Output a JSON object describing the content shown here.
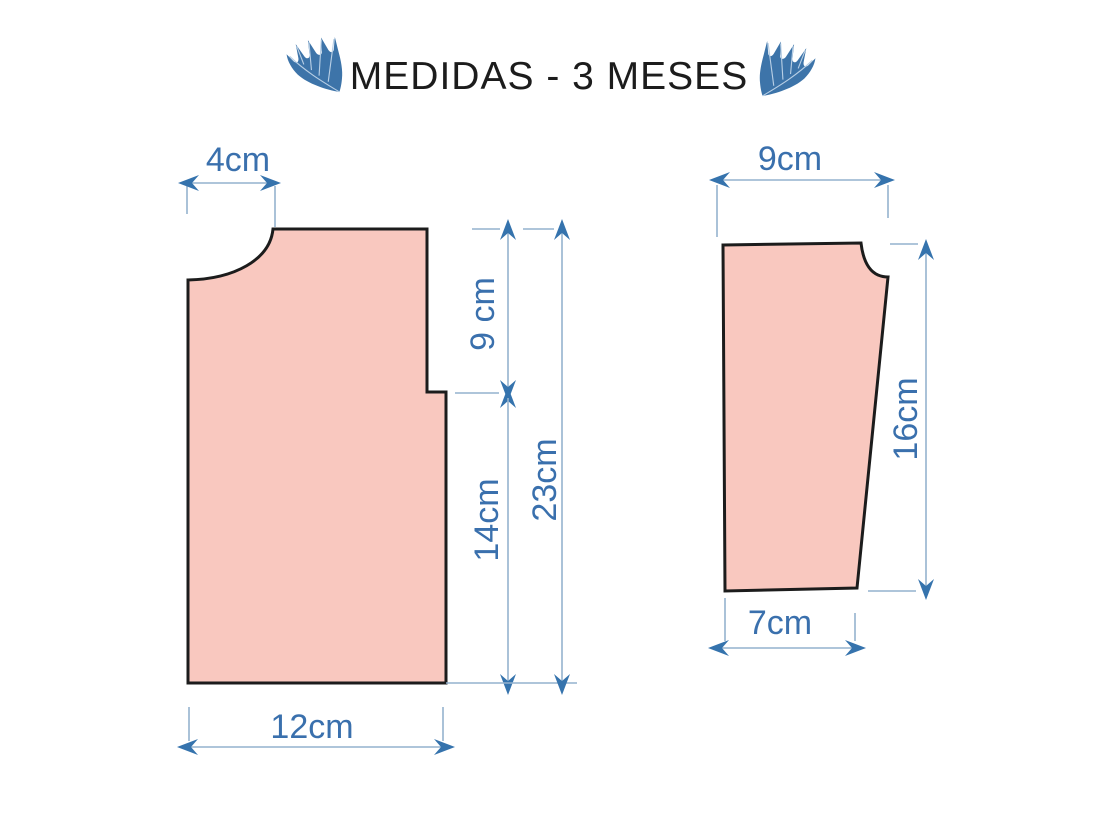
{
  "title": "MEDIDAS - 3 MESES",
  "colors": {
    "background": "#ffffff",
    "title_text": "#1c1c1c",
    "piece_fill": "#f9c8bf",
    "piece_outline": "#1c1c1c",
    "dimension_line": "#94b2ce",
    "arrow": "#3573ad",
    "label_text": "#3a70ad",
    "leaf": "#3d74a9",
    "leaf_vein": "#b8cfe5"
  },
  "decorations": {
    "left": "leaf-icon",
    "right": "leaf-icon"
  },
  "pieces": {
    "bodice": {
      "shoulder": "4cm",
      "armhole_depth": "9 cm",
      "side_below_armhole": "14cm",
      "total_length": "23cm",
      "bottom_width": "12cm"
    },
    "sleeve": {
      "top_width": "9cm",
      "length": "16cm",
      "bottom_width": "7cm"
    }
  }
}
